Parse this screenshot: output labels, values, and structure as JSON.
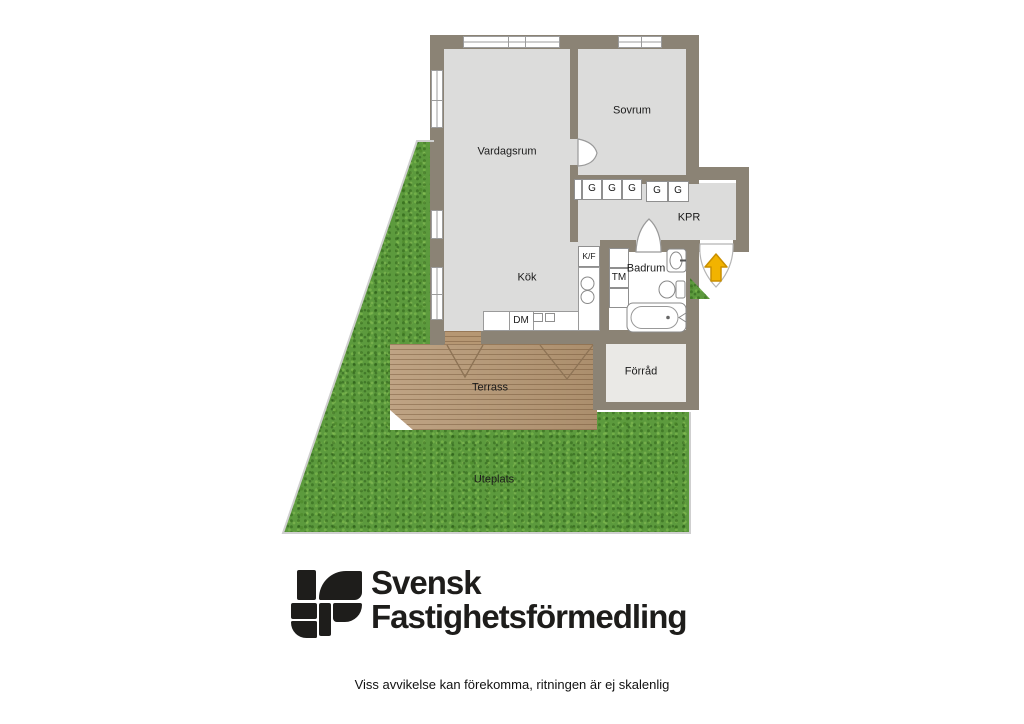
{
  "floorplan": {
    "rooms": {
      "vardagsrum": "Vardagsrum",
      "sovrum": "Sovrum",
      "kok": "Kök",
      "kpr": "KPR",
      "badrum": "Badrum",
      "forrad": "Förråd",
      "terrass": "Terrass",
      "uteplats": "Uteplats"
    },
    "fixtures": {
      "wardrobe": "G",
      "fridge_freezer": "K/F",
      "washing_machine": "TM",
      "dishwasher": "DM"
    },
    "colors": {
      "wall": "#8b8375",
      "floor": "#dcdcdb",
      "bathroom_floor": "#ffffff",
      "storage_floor": "#eae9e6",
      "grass": "#5c9a3d",
      "deck": "#b69773",
      "entrance_arrow": "#f2b300"
    }
  },
  "branding": {
    "line1": "Svensk",
    "line2": "Fastighetsförmedling"
  },
  "disclaimer": "Viss avvikelse kan förekomma, ritningen är ej skalenlig"
}
